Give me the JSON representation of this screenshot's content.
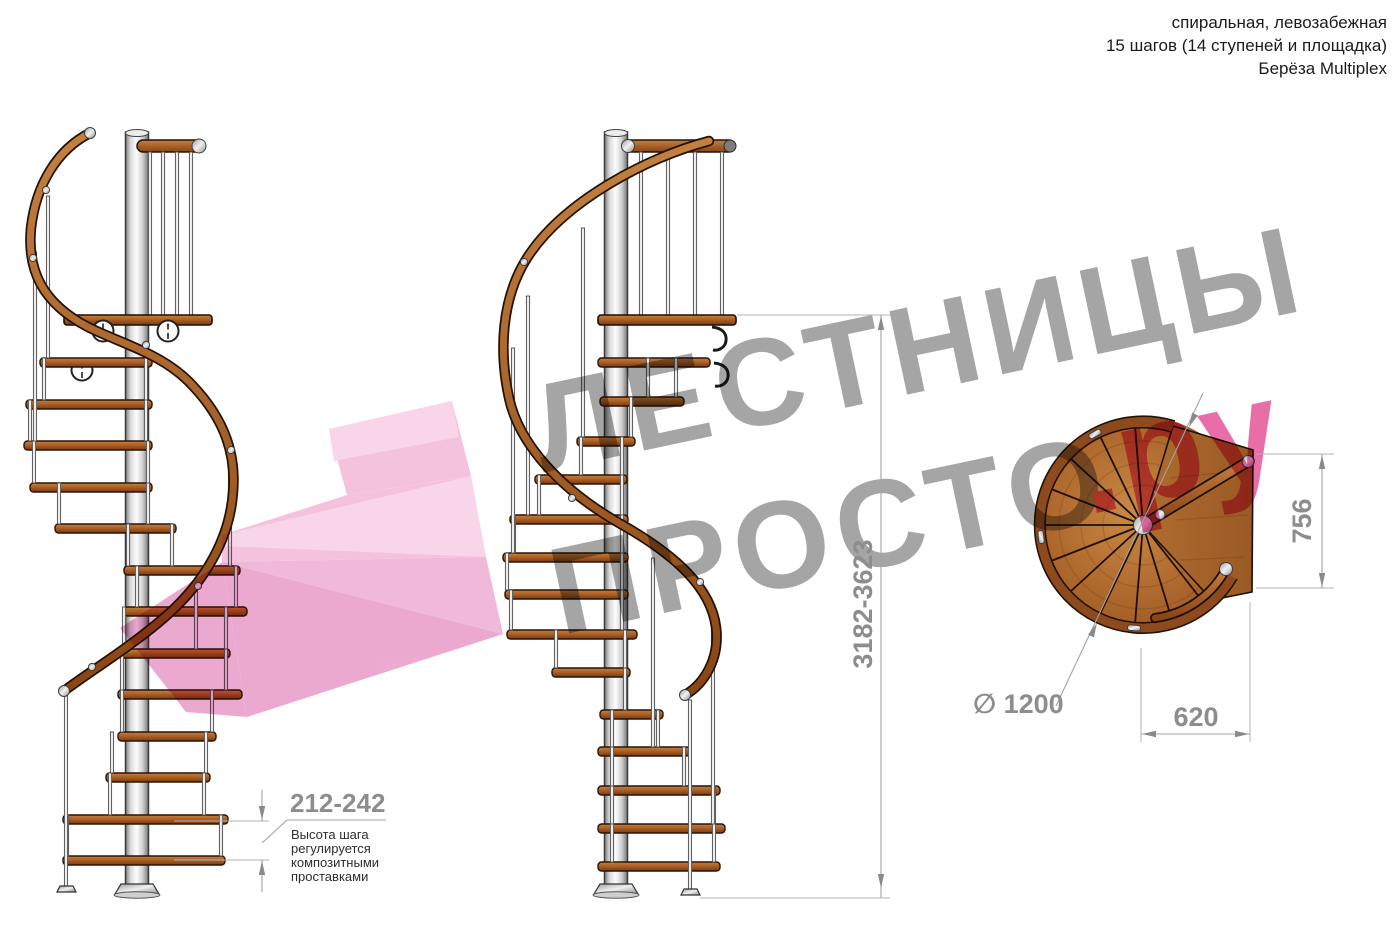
{
  "header": {
    "line1": "спиральная, левозабежная",
    "line2": "15 шагов (14 ступеней и площадка)",
    "line3": "Берёза Multiplex"
  },
  "watermark": {
    "brand_word": "ЛЕСТНИЦЫ",
    "brand_word2": "ПРОСТО",
    "brand_suffix": ".ру"
  },
  "dimensions": {
    "total_height": "3182-3623",
    "landing_depth": "756",
    "landing_width": "620",
    "diameter": "∅ 1200",
    "step_height": "212-242",
    "step_note": {
      "line1": "Высота шага",
      "line2": "регулируется",
      "line3": "композитными",
      "line4": "проставками"
    }
  },
  "colors": {
    "wood": "#a8602a",
    "wood_dark": "#7a3b10",
    "rail_wood": "#a05a26",
    "pole_silver": "#d5d5d5",
    "dim_gray": "#a3a3a3",
    "dim_text_gray": "#8d8d8d",
    "note_text": "#2e2e2e",
    "watermark_gray": "#9b9b9b",
    "watermark_pink": "#e75c9c",
    "logo_pink_light": "#f7c8e3",
    "logo_pink": "#f2b0d5",
    "logo_pink_mid": "#eda4ce",
    "logo_pink_deep": "#e78fc2"
  }
}
